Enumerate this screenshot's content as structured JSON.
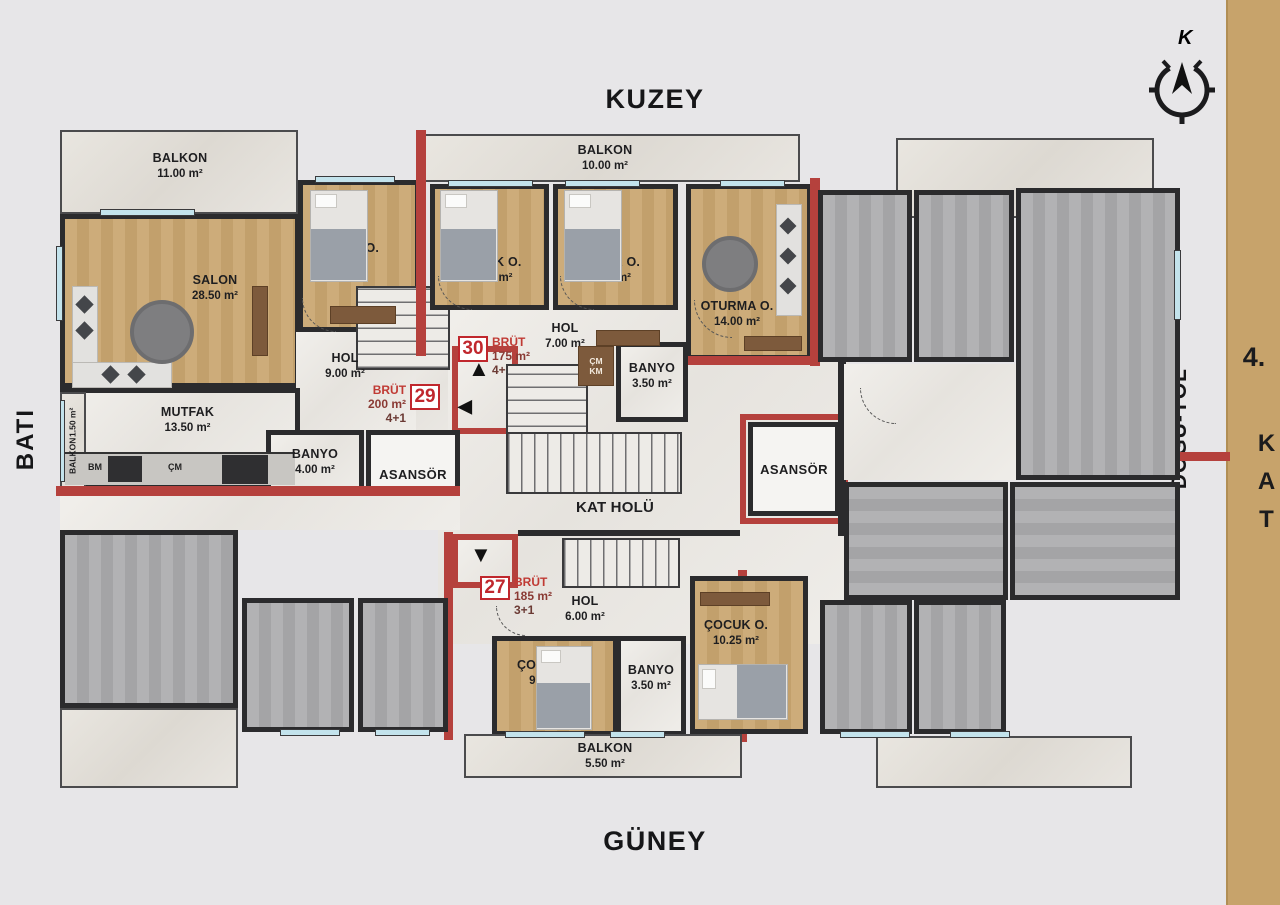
{
  "directions": {
    "north": "KUZEY",
    "south": "GÜNEY",
    "west": "BATI",
    "east": "DOĞU-YOL",
    "compass_letter": "K"
  },
  "floor": {
    "number": "4.",
    "word": "KAT"
  },
  "apartments": [
    {
      "no": "30",
      "brut": "BRÜT",
      "area": "175 m²",
      "plan": "4+1"
    },
    {
      "no": "29",
      "brut": "BRÜT",
      "area": "200 m²",
      "plan": "4+1"
    },
    {
      "no": "27",
      "brut": "BRÜT",
      "area": "185 m²",
      "plan": "3+1"
    }
  ],
  "rooms": {
    "balkon_nw": {
      "name": "BALKON",
      "area": "11.00 m²"
    },
    "balkon_n": {
      "name": "BALKON",
      "area": "10.00 m²"
    },
    "balkon_w": {
      "name": "BALKON",
      "area": "1.50 m²"
    },
    "balkon_s": {
      "name": "BALKON",
      "area": "5.50 m²"
    },
    "salon": {
      "name": "SALON",
      "area": "28.50 m²"
    },
    "cocuk_nw": {
      "name": "ÇOCUK O.",
      "area": "8.50 m²"
    },
    "cocuk_n1": {
      "name": "ÇOCUK O.",
      "area": "10.50 m²"
    },
    "cocuk_n2": {
      "name": "ÇOCUK O.",
      "area": "10.50 m²"
    },
    "oturma": {
      "name": "OTURMA O.",
      "area": "14.00 m²"
    },
    "hol29": {
      "name": "HOL",
      "area": "9.00 m²"
    },
    "hol30": {
      "name": "HOL",
      "area": "7.00 m²"
    },
    "hol27": {
      "name": "HOL",
      "area": "6.00 m²"
    },
    "mutfak": {
      "name": "MUTFAK",
      "area": "13.50 m²"
    },
    "banyo29": {
      "name": "BANYO",
      "area": "4.00 m²"
    },
    "banyo30": {
      "name": "BANYO",
      "area": "3.50 m²"
    },
    "banyo27": {
      "name": "BANYO",
      "area": "3.50 m²"
    },
    "cocuk_s1": {
      "name": "ÇOCUK O.",
      "area": "9.25 m²"
    },
    "cocuk_s2": {
      "name": "ÇOCUK O.",
      "area": "10.25 m²"
    },
    "kat_holu": {
      "name": "KAT HOLÜ"
    },
    "asansor_left": {
      "name": "ASANSÖR"
    },
    "asansor_right": {
      "name": "ASANSÖR"
    }
  },
  "kitchen": {
    "bm": "BM",
    "cm": "ÇM"
  },
  "closet": {
    "top": "ÇM",
    "bottom": "KM"
  },
  "arrows": {
    "up": "▲",
    "left": "◀",
    "down": "▼"
  },
  "colors": {
    "wall": "#2b2b2d",
    "red_wall": "#b5413d",
    "tag_red": "#c0272d",
    "tan_strip": "#c7a36b",
    "window_glass": "#c3e3ec",
    "wood_floor": "#c6a472",
    "gray_floor": "#aaaaac",
    "marble": "#ebe9e5"
  }
}
